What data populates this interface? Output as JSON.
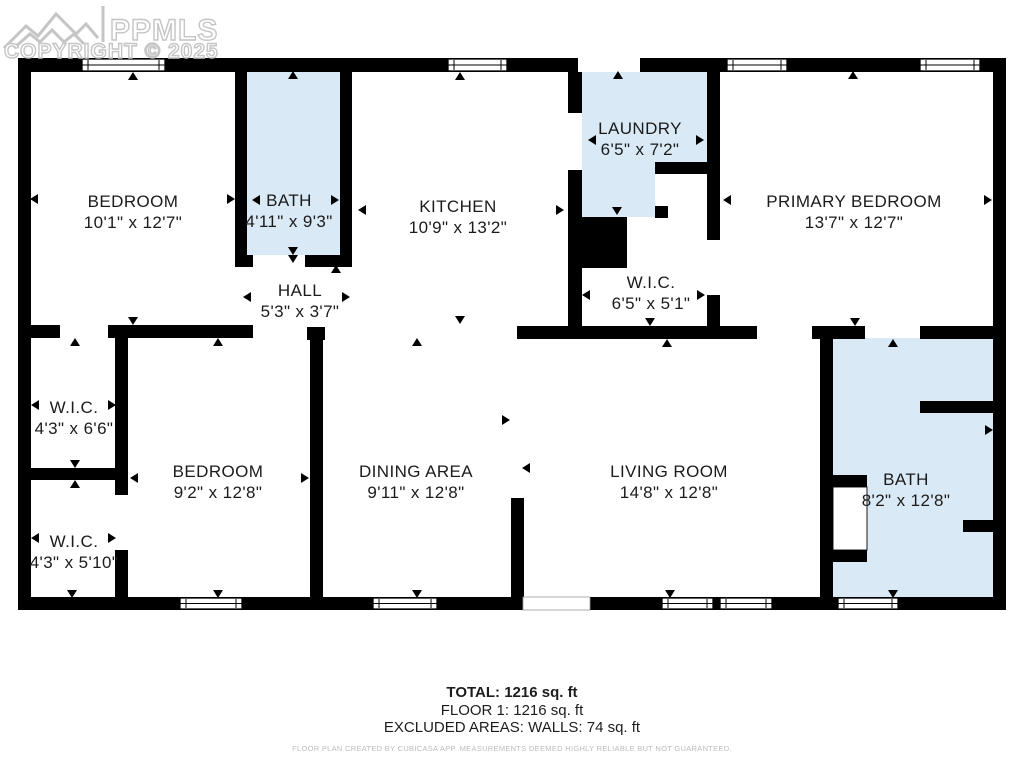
{
  "watermark": {
    "brand": "PPMLS",
    "copyright": "COPYRIGHT © 2025",
    "color": "#c5c5c5"
  },
  "floorplan": {
    "wall_color": "#000000",
    "wet_room_fill": "#d9e9f5",
    "label_color": "#1b1b1b",
    "rooms": [
      {
        "name": "bedroom-1",
        "label": "BEDROOM",
        "dims": "10'1\" x 12'7\"",
        "cx": 133,
        "cy": 212
      },
      {
        "name": "bath-1",
        "label": "BATH",
        "dims": "4'11\" x 9'3\"",
        "cx": 289,
        "cy": 211
      },
      {
        "name": "kitchen",
        "label": "KITCHEN",
        "dims": "10'9\" x 13'2\"",
        "cx": 458,
        "cy": 217
      },
      {
        "name": "laundry",
        "label": "LAUNDRY",
        "dims": "6'5\" x 7'2\"",
        "cx": 640,
        "cy": 139
      },
      {
        "name": "primary-bedroom",
        "label": "PRIMARY BEDROOM",
        "dims": "13'7\" x 12'7\"",
        "cx": 854,
        "cy": 212
      },
      {
        "name": "wic-center",
        "label": "W.I.C.",
        "dims": "6'5\" x 5'1\"",
        "cx": 651,
        "cy": 293
      },
      {
        "name": "hall",
        "label": "HALL",
        "dims": "5'3\" x 3'7\"",
        "cx": 300,
        "cy": 301
      },
      {
        "name": "wic-upper-left",
        "label": "W.I.C.",
        "dims": "4'3\" x 6'6\"",
        "cx": 74,
        "cy": 418
      },
      {
        "name": "wic-lower-left",
        "label": "W.I.C.",
        "dims": "4'3\" x 5'10\"",
        "cx": 74,
        "cy": 552
      },
      {
        "name": "bedroom-2",
        "label": "BEDROOM",
        "dims": "9'2\" x 12'8\"",
        "cx": 218,
        "cy": 482
      },
      {
        "name": "dining-area",
        "label": "DINING AREA",
        "dims": "9'11\" x 12'8\"",
        "cx": 416,
        "cy": 482
      },
      {
        "name": "living-room",
        "label": "LIVING ROOM",
        "dims": "14'8\" x 12'8\"",
        "cx": 669,
        "cy": 482
      },
      {
        "name": "bath-2",
        "label": "BATH",
        "dims": "8'2\" x 12'8\"",
        "cx": 906,
        "cy": 490
      }
    ]
  },
  "summary": {
    "total": "TOTAL: 1216 sq. ft",
    "floor": "FLOOR 1: 1216 sq. ft",
    "excluded": "EXCLUDED AREAS: WALLS: 74 sq. ft",
    "disclaimer": "FLOOR PLAN CREATED BY CUBICASA APP. MEASUREMENTS DEEMED HIGHLY RELIABLE BUT NOT GUARANTEED."
  }
}
